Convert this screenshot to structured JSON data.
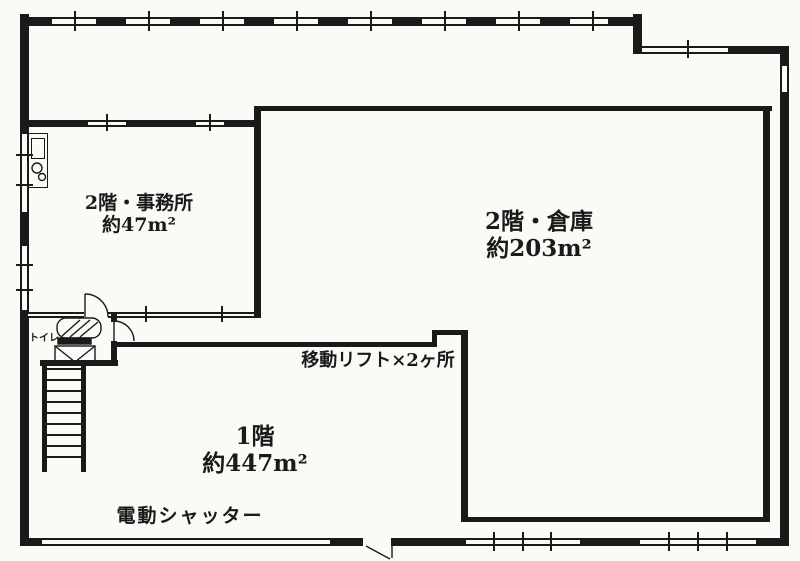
{
  "plan": {
    "type": "floor-plan",
    "rooms": {
      "office_2f": {
        "name": "2階・事務所",
        "area": "約47m²"
      },
      "warehouse_2f": {
        "name": "2階・倉庫",
        "area": "約203m²"
      },
      "floor_1f": {
        "name": "1階",
        "area": "約447m²"
      }
    },
    "annotations": {
      "lift": "移動リフト×2ヶ所",
      "shutter": "電動シャッター",
      "toilet": "トイレ"
    },
    "features": {
      "staircase": "staircase",
      "kitchenette": "kitchenette-unit",
      "doors": "swing-doors",
      "windows": "window-bands"
    },
    "colors": {
      "line": "#1a1a1a",
      "paper": "#fbfaf6"
    }
  }
}
